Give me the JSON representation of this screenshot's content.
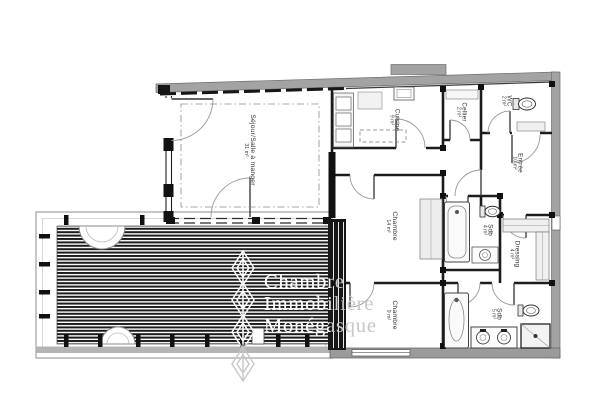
{
  "watermark": {
    "line1": "Chambre",
    "line2": "Immobilière",
    "line3": "Monégasque",
    "logo": "diamond-chain-logo"
  },
  "rooms": [
    {
      "name": "Séjour/Salle à manger",
      "area": "31 m²"
    },
    {
      "name": "Cuisine",
      "area": "9 m²"
    },
    {
      "name": "Cellier",
      "area": "2 m²"
    },
    {
      "name": "WC",
      "area": "2 m²"
    },
    {
      "name": "Entrée",
      "area": "10 m²"
    },
    {
      "name": "Chambre",
      "area": "14 m²"
    },
    {
      "name": "Sdb",
      "area": "4 m²"
    },
    {
      "name": "Dressing",
      "area": "4 m²"
    },
    {
      "name": "Chambre",
      "area": "9 m²"
    },
    {
      "name": "Sdb",
      "area": "5 m²"
    }
  ],
  "colors": {
    "exterior_wall": "#a3a3a3",
    "interior_wall": "#1c1c1c",
    "deck_stripe": "#1c1c1c",
    "terrace_border": "#adadad",
    "watermark_gray": "#c7c7c7",
    "watermark_white": "#fcfcfc",
    "background": "#ffffff"
  }
}
